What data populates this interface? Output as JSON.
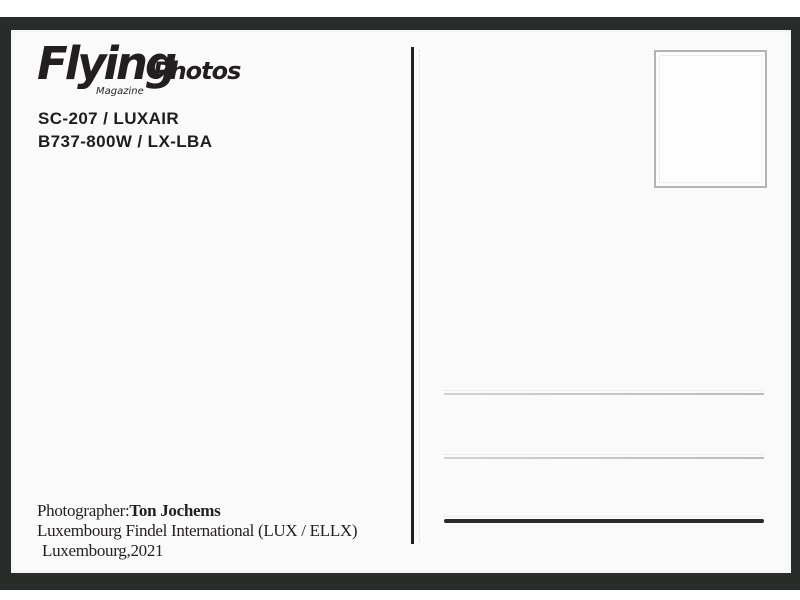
{
  "postcard": {
    "logo": {
      "brand": "Flying",
      "brand_suffix": "Photos",
      "subtitle": "Magazine"
    },
    "caption": {
      "line1": "SC-207 / LUXAIR",
      "line2": "B737-800W / LX-LBA"
    },
    "credits": {
      "photographer_label": "Photographer:",
      "photographer_name": "Ton Jochems",
      "location": "Luxembourg Findel International (LUX / ELLX)",
      "place_year": "Luxembourg,2021"
    },
    "colors": {
      "frame": "#282d29",
      "card": "#fbfafa",
      "ink": "#231f20",
      "light_rule": "#c9c6c6",
      "dark_rule": "#2b2b2b",
      "stamp_border": "#b3b3b3"
    }
  }
}
